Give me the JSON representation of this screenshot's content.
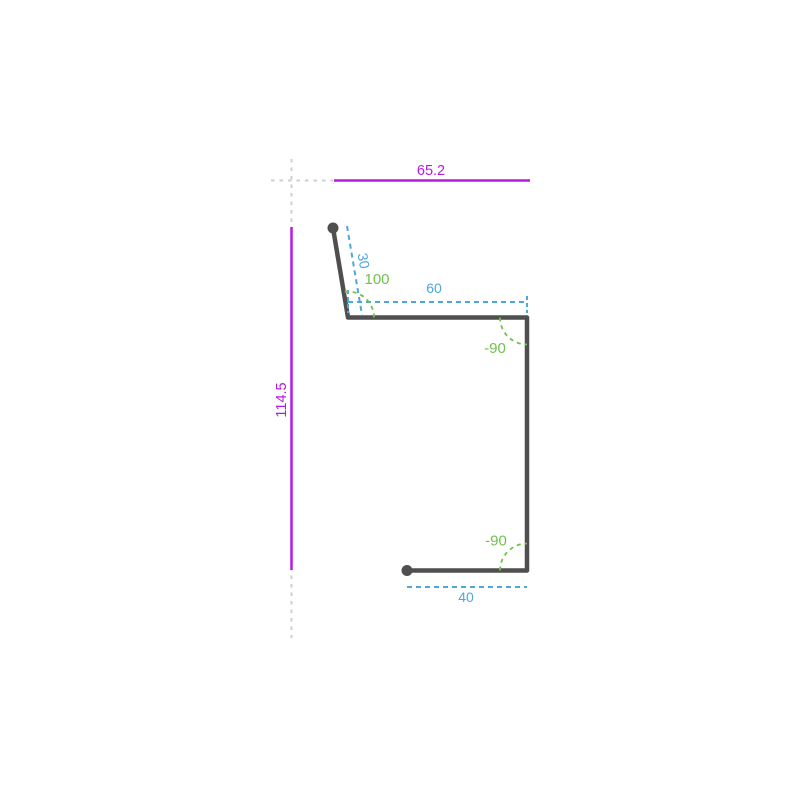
{
  "drawing": {
    "colors": {
      "overall_dimension": "#b51ae0",
      "segment_dimension": "#4da7d9",
      "angle_annotation": "#70c14e",
      "profile": "#4f4f4f",
      "construction": "#cfcfcf"
    },
    "dimensions": {
      "overall_width": "65.2",
      "overall_height": "114.5"
    },
    "segments": {
      "seg1_length": "30",
      "seg2_length": "60",
      "seg4_length": "40"
    },
    "angles": {
      "bend1": "100",
      "bend2": "-90",
      "bend3": "-90"
    }
  }
}
